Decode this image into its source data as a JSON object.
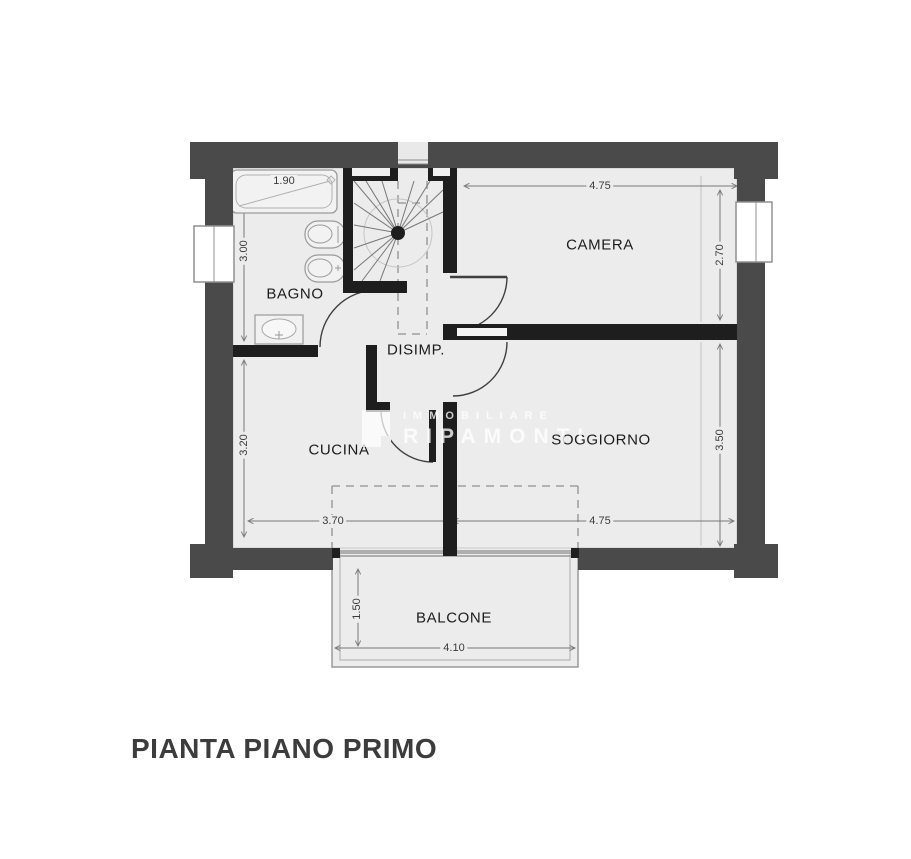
{
  "title": "PIANTA PIANO PRIMO",
  "watermark": {
    "brand_top": "IMMOBILIARE",
    "brand_bottom": "RIPAMONTI"
  },
  "rooms": {
    "bagno": "BAGNO",
    "camera": "CAMERA",
    "disimp": "DISIMP.",
    "cucina": "CUCINA",
    "soggiorno": "SOGGIORNO",
    "balcone": "BALCONE"
  },
  "dimensions": {
    "vasca_width": "1.90",
    "bagno_depth": "3.00",
    "camera_width": "4.75",
    "camera_depth": "2.70",
    "cucina_depth": "3.20",
    "soggiorno_depth": "3.50",
    "cucina_width": "3.70",
    "soggiorno_width": "4.75",
    "balcone_depth": "1.50",
    "balcone_width": "4.10"
  },
  "colors": {
    "exterior_wall": "#4a4a4a",
    "interior_wall": "#1e1e1e",
    "floor": "#ececec",
    "line": "#777777",
    "title_text": "#3c3c3c"
  }
}
